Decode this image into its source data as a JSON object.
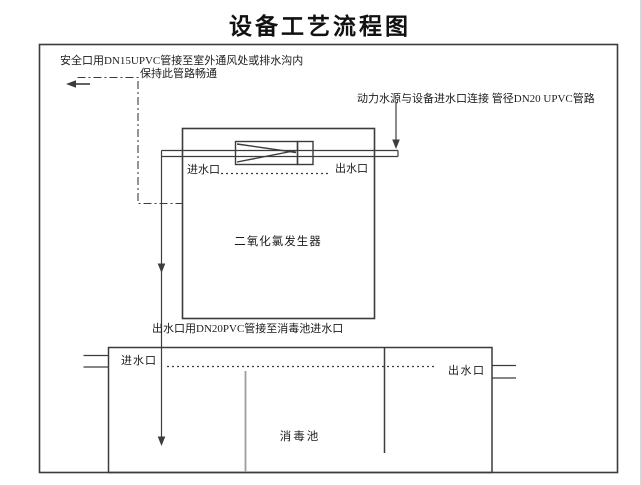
{
  "title": "设备工艺流程图",
  "notes": {
    "safety_line1": "安全口用DN15UPVC管接至室外通风处或排水沟内",
    "safety_line2": "保持此管路畅通",
    "power_supply": "动力水源与设备进水口连接 管径DN20 UPVC管路",
    "outlet_pipe": "出水口用DN20PVC管接至消毒池进水口"
  },
  "generator": {
    "name": "二氧化氯发生器",
    "inlet_label": "进水口",
    "outlet_label": "出水口"
  },
  "pool": {
    "name": "消毒池",
    "inlet_label": "进水口",
    "outlet_label": "出水口"
  },
  "colors": {
    "line": "#3c3c3c",
    "divider_gray": "#9c9c9c",
    "text": "#1c1c1c",
    "background": "#ffffff"
  }
}
